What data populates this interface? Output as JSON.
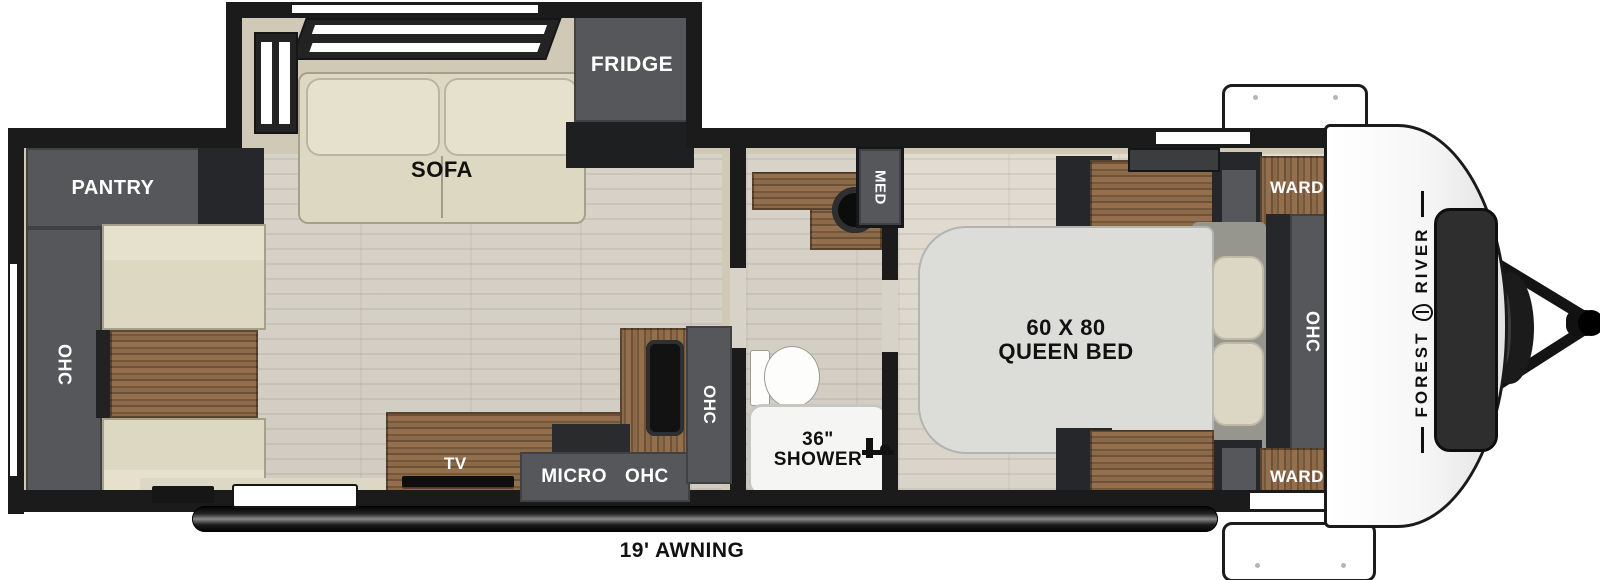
{
  "colors": {
    "cabinet": "#55575a",
    "cabinet_dark": "#26272a",
    "beige": "#cfc9b6",
    "cushion": "#ddd8c2",
    "cushion_light": "#e6e1cd",
    "wall": "#1b1b1b",
    "floor": "#d8d3c9",
    "mattress": "#dcdcd9",
    "wood": "#8a6a48"
  },
  "labels": {
    "pantry": "PANTRY",
    "rear_ohc": "OHC",
    "sofa": "SOFA",
    "fridge": "FRIDGE",
    "tv": "TV",
    "micro": "MICRO",
    "kitchen_ohc": "OHC",
    "kitchen_ohc_tall": "OHC",
    "med": "MED",
    "shower_size": "36\"",
    "shower": "SHOWER",
    "bed_size": "60 X 80",
    "bed_type": "QUEEN BED",
    "ward_front": "WARD",
    "ward_rear": "WARD",
    "bedroom_ohc": "OHC",
    "brand_first": "FOREST",
    "brand_last": "RIVER",
    "awning": "19' AWNING"
  }
}
